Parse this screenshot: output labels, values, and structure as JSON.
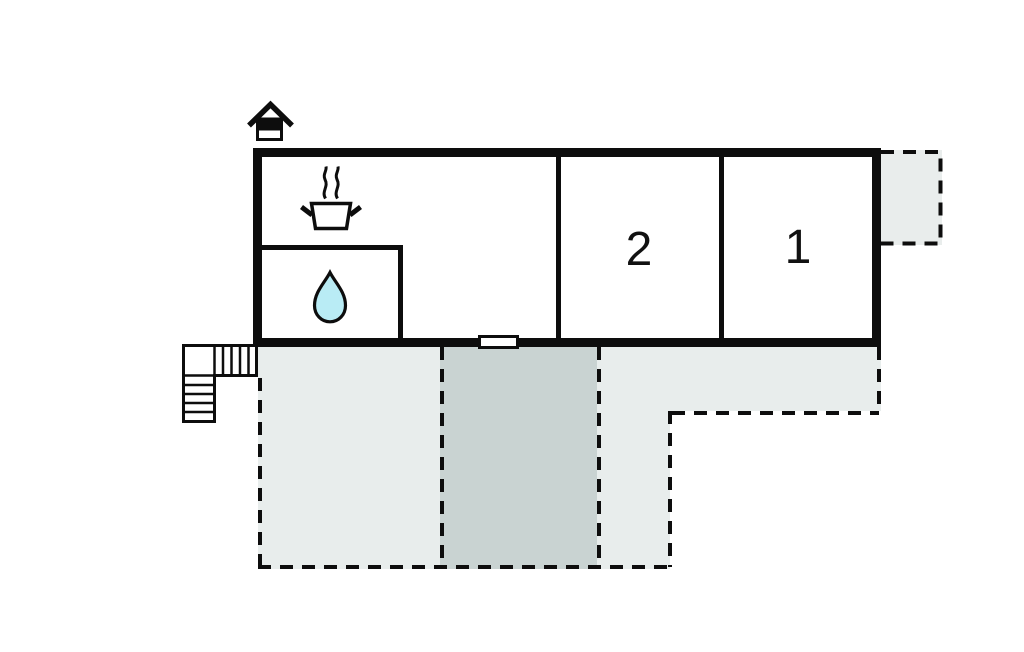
{
  "plan": {
    "rooms": [
      {
        "id": "room-1",
        "label": "1"
      },
      {
        "id": "room-2",
        "label": "2"
      }
    ],
    "icons": {
      "entrance": "entrance-house-icon",
      "kitchen": "cooking-pot-icon",
      "bathroom": "water-drop-icon",
      "stairs": "stairs"
    },
    "colors": {
      "line": "#0d0d0d",
      "terrace_light": "#e8edec",
      "terrace_dark": "#c9d3d2",
      "annex_fill": "#e9edec",
      "water_drop_fill": "#b9ecf5",
      "background": "#ffffff"
    }
  }
}
